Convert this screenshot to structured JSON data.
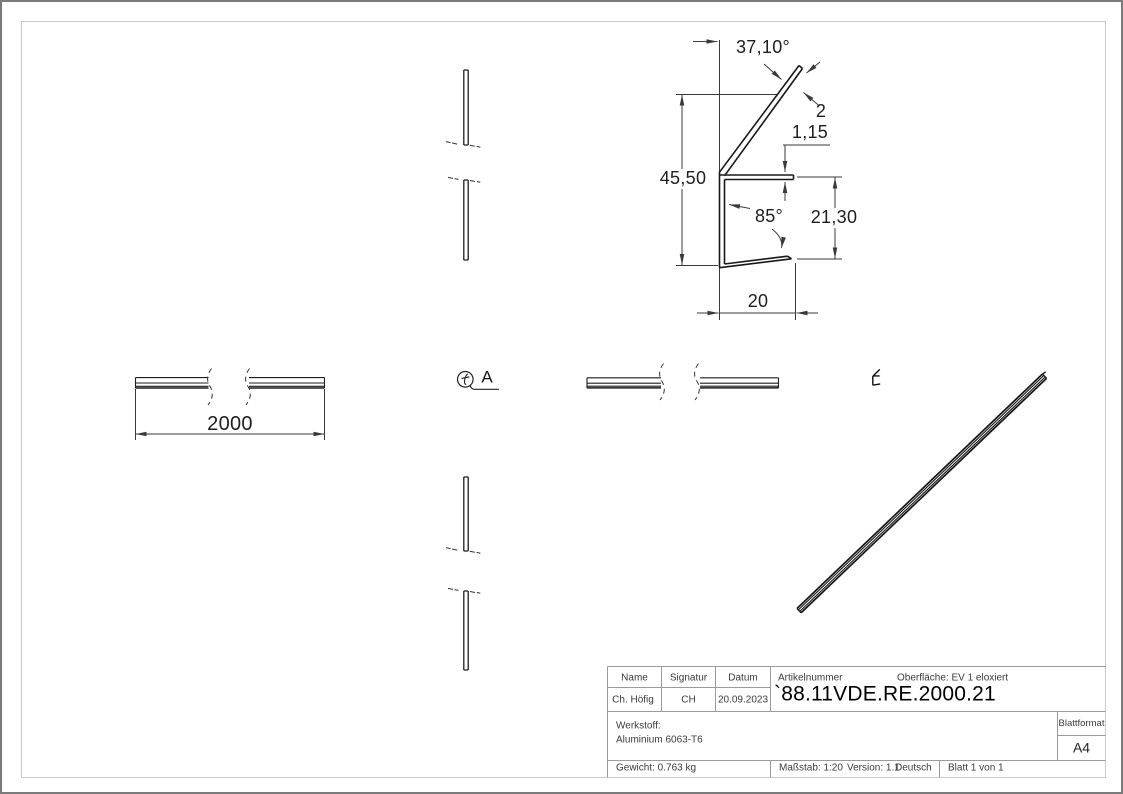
{
  "sheet": {
    "format_label": "Blattformat",
    "format_value": "A4"
  },
  "drawing": {
    "dims": {
      "flange_angle": "37,10°",
      "flange_thickness": "2",
      "lip_thickness": "1,15",
      "total_height": "45,50",
      "lip_angle": "85°",
      "channel_height": "21,30",
      "channel_width": "20",
      "profile_length": "2000"
    },
    "view_label": "A"
  },
  "title_block": {
    "name_label": "Name",
    "signature_label": "Signatur",
    "date_label": "Datum",
    "name_value": "Ch. Höfig",
    "signature_value": "CH",
    "date_value": "20.09.2023",
    "article_number_label": "Artikelnummer",
    "surface": "Oberfläche:  EV 1 eloxiert",
    "article_number": "`88.11VDE.RE.2000.21",
    "material_label": "Werkstoff:",
    "material_value": "Aluminium 6063-T6",
    "weight": "Gewicht: 0.763 kg",
    "scale": "Maßstab: 1:20",
    "version": "Version: 1.1",
    "language": "Deutsch",
    "sheet_count": "Blatt 1 von 1"
  }
}
